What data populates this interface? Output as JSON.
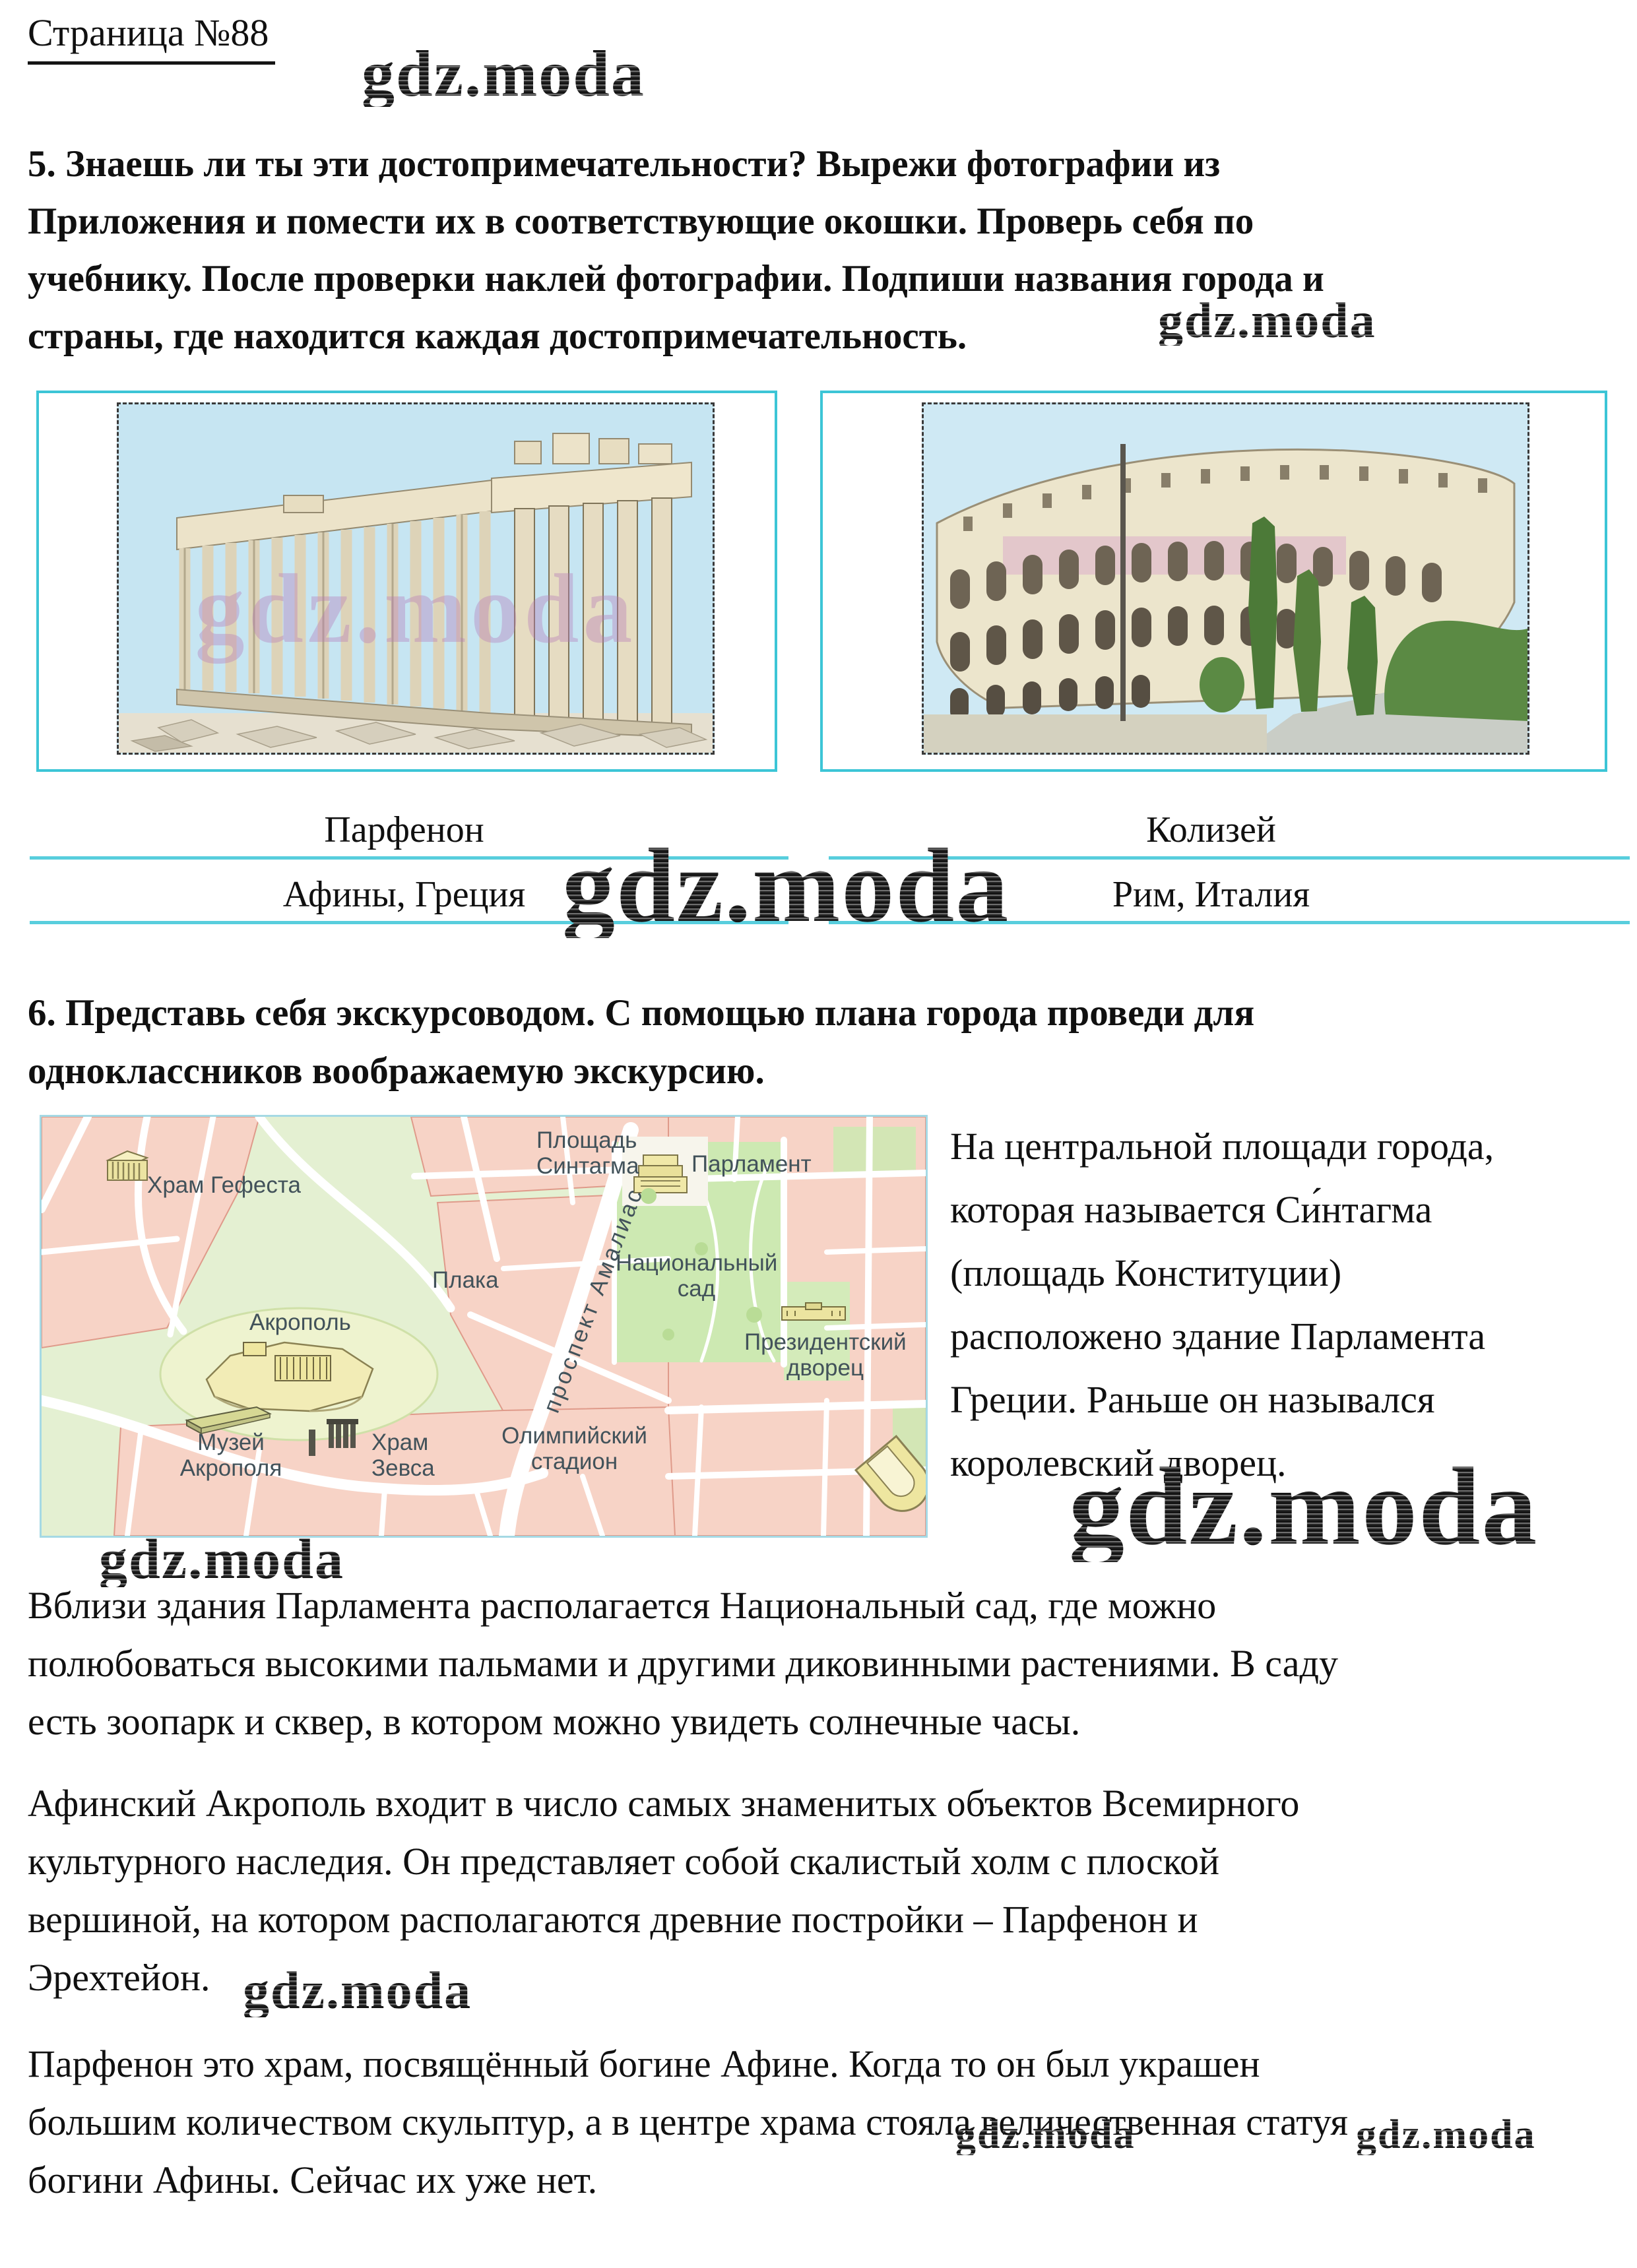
{
  "page": {
    "title": "Страница №88"
  },
  "watermark": {
    "text": "gdz.moda"
  },
  "task5": {
    "lines": [
      "5. Знаешь ли ты эти достопримечательности? Вырежи фотографии из",
      "Приложения и помести их в соответствующие окошки. Проверь себя по",
      "учебнику. После проверки наклей фотографии. Подпиши названия города и",
      "страны, где находится каждая достопримечательность."
    ]
  },
  "gallery": {
    "left": {
      "name": "Парфенон",
      "location": "Афины, Греция"
    },
    "right": {
      "name": "Колизей",
      "location": "Рим, Италия"
    }
  },
  "task6": {
    "lines": [
      "6. Представь себя экскурсоводом. С помощью плана города проведи для",
      "одноклассников воображаемую экскурсию."
    ]
  },
  "map": {
    "labels": {
      "hephaestus": "Храм Гефеста",
      "syntagma": "Площадь\nСинтагма",
      "parliament": "Парламент",
      "garden": "Национальный\nсад",
      "plaka": "Плака",
      "amalias": "проспект Амалиас",
      "acropolis": "Акрополь",
      "palace": "Президентский\nдворец",
      "museum": "Музей\nАкрополя",
      "zeus": "Храм\nЗевса",
      "stadium": "Олимпийский\nстадион"
    }
  },
  "answer": {
    "lines": [
      "На центральной площади города,",
      "которая называется Си́нтагма",
      "(площадь Конституции)",
      "расположено здание Парламента",
      "Греции. Раньше он назывался",
      "королевский дворец."
    ]
  },
  "paragraphs": {
    "p1": {
      "lines": [
        "Вблизи здания Парламента располагается Национальный сад, где можно",
        "полюбоваться высокими пальмами и другими диковинными растениями. В саду",
        "есть зоопарк и сквер, в котором можно увидеть солнечные часы."
      ]
    },
    "p2": {
      "lines": [
        "Афинский Акрополь входит в число самых знаменитых объектов Всемирного",
        "культурного наследия. Он представляет собой скалистый холм с плоской",
        "вершиной, на котором располагаются древние постройки – Парфенон и",
        "Эрехтейон."
      ]
    },
    "p3": {
      "lines": [
        "Парфенон это храм, посвящённый богине Афине. Когда то он был украшен",
        "большим количеством скульптур, а в центре храма стояла величественная статуя",
        "богини Афины. Сейчас их уже нет."
      ]
    }
  },
  "colors": {
    "accent_cyan": "#3cc5d6",
    "rule_cyan": "#58cedd",
    "map_label": "#42525a",
    "photo_watermark_purple": "#b678b8",
    "map_block_pink": "#f7d3c6",
    "map_green": "#e4f0d2"
  }
}
